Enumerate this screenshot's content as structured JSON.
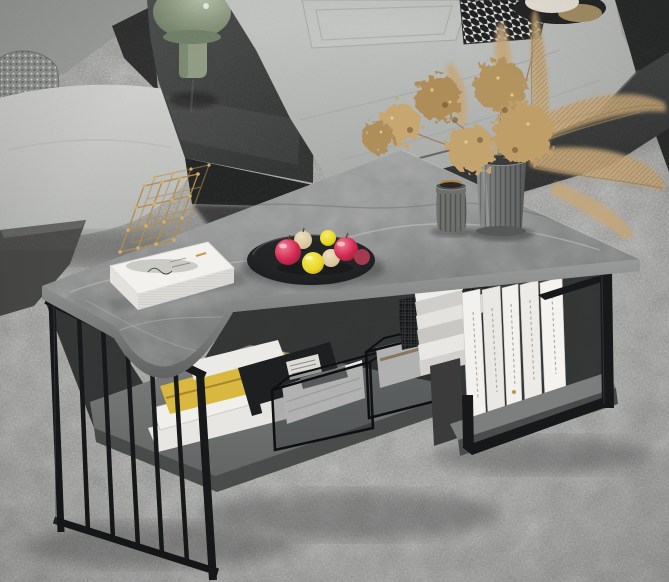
{
  "image": {
    "alt": "Lifestyle photograph of a modern rectangular coffee table with a grey marble-look top and black metal frame; the left end has vertical black slats and the right end an open metal loop. Under the top, a split-level grey marble shelf holds magazines, clear boxes with folded white towels, a wire mesh basket and upright white books. On the top sit a white hardcover book with a gold wire lattice sculpture, a black plate of red apples and yellow lemons, a smoked-glass candle holder and a ribbed glass vase of dried tan hydrangea and pampas grass. Behind is a grey fabric sectional sofa with a dark built-in console carrying a sage-green mushroom lamp, all on a mottled grey carpet.",
    "style": "product lifestyle photo, no visible text"
  },
  "objects": [
    {
      "name": "carpet",
      "label": "mottled grey carpet"
    },
    {
      "name": "sectional-sofa",
      "label": "grey fabric sectional sofa"
    },
    {
      "name": "accent-pillow-speckled",
      "label": "speckled grey accent pillow"
    },
    {
      "name": "accent-pillow-houndstooth",
      "label": "houndstooth accent pillow"
    },
    {
      "name": "console-table",
      "label": "dark glossy built-in console"
    },
    {
      "name": "green-table-lamp",
      "label": "sage green mushroom table lamp"
    },
    {
      "name": "cream-table-lamp",
      "label": "cream globe lamp behind sofa"
    },
    {
      "name": "black-side-table",
      "label": "black side table at right edge"
    },
    {
      "name": "coffee-table",
      "label": "grey marble coffee table with black metal frame"
    },
    {
      "name": "marble-tabletop",
      "label": "grey marble-look tabletop"
    },
    {
      "name": "slatted-frame",
      "label": "black vertical-slat end frame"
    },
    {
      "name": "loop-frame",
      "label": "black open loop end frame"
    },
    {
      "name": "lower-shelf",
      "label": "lower marble storage shelf"
    },
    {
      "name": "raised-shelf",
      "label": "raised marble shelf section"
    },
    {
      "name": "magazines",
      "label": "stack of magazines and papers"
    },
    {
      "name": "storage-boxes",
      "label": "clear boxes with folded towels"
    },
    {
      "name": "mesh-basket",
      "label": "black wire mesh basket"
    },
    {
      "name": "shelf-books",
      "label": "upright white books"
    },
    {
      "name": "hardcover-book",
      "label": "white hardcover book"
    },
    {
      "name": "gold-sculpture",
      "label": "gold wire lattice sculpture"
    },
    {
      "name": "fruit-plate",
      "label": "black plate with apples and lemons"
    },
    {
      "name": "candle-holder",
      "label": "smoked glass candle holder"
    },
    {
      "name": "ribbed-vase",
      "label": "ribbed glass vase"
    },
    {
      "name": "dried-hydrangea",
      "label": "dried tan hydrangea"
    },
    {
      "name": "pampas-grass",
      "label": "dried pampas grass plumes"
    }
  ],
  "colors": {
    "carpet": "#9b9b99",
    "sofaLight": "#c9cac7",
    "sofaMid": "#b3b5b3",
    "sofaSeam": "#9b9d9b",
    "sofaBase": "#303231",
    "console": "#3c3e3d",
    "consoleShade": "#1f2020",
    "lampGreen": "#8e9c82",
    "lampCream": "#ebe6da",
    "marbleLight": "#a9abaa",
    "marbleMid": "#8b8d8c",
    "marbleDark": "#747675",
    "marbleEdge": "#616362",
    "shelfTop": "#7d7f7e",
    "shelfEdge": "#4a4c4b",
    "metal": "#17181a",
    "metalSheen": "#3e3f41",
    "bookWhite": "#f2f1ee",
    "pageGray": "#dcdbd7",
    "gold": "#b08c4f",
    "goldLight": "#d3ae6c",
    "plate": "#1c1d1e",
    "appleRed": "#d12b52",
    "appleDeep": "#8c1834",
    "lemon": "#e7d626",
    "beigeFruit": "#d7c39c",
    "glass": "#656765",
    "amber": "#b5813e",
    "vase": "#757877",
    "driedTan": "#bb9c68",
    "driedShadow": "#8f7447",
    "pampas": "#c5a77b",
    "towel": "#e9e9e6",
    "magazineGold": "#d8b83e",
    "ink": "#1e1f20",
    "houndsDark": "#1b1c1d",
    "houndsLight": "#e6e6e3",
    "ottoman": "#474846",
    "trayTan": "#a68e63"
  }
}
